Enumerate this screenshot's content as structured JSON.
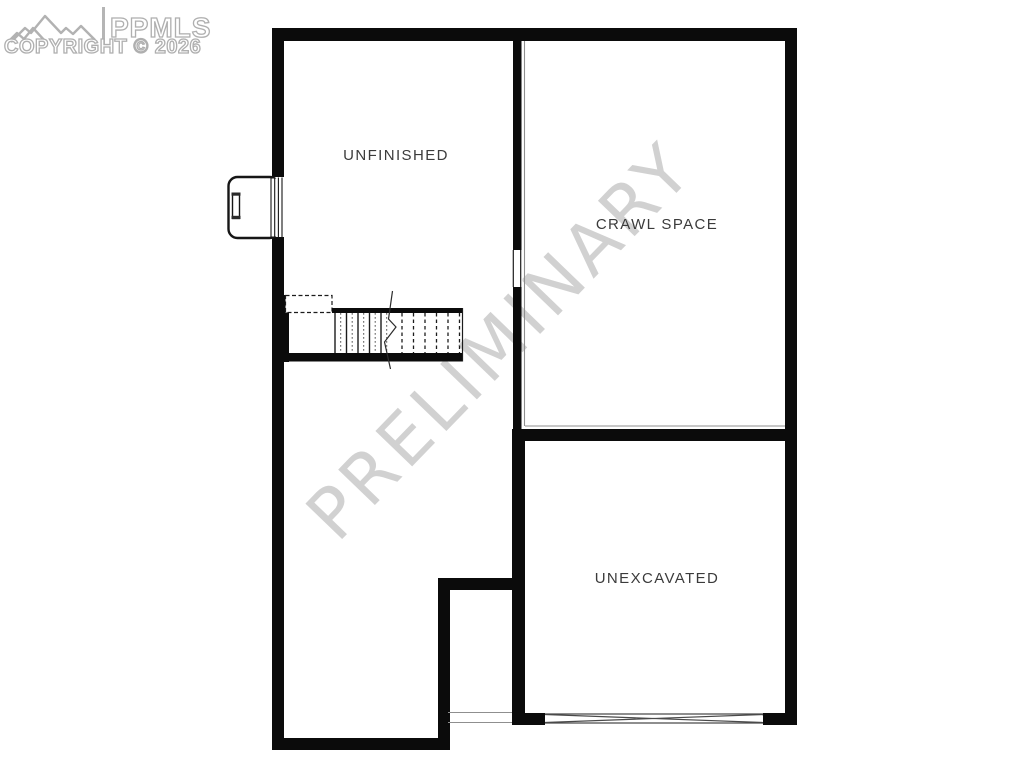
{
  "logo": {
    "brand": "PPMLS",
    "copyright": "COPYRIGHT © 2026",
    "icon": "mountain-range-icon",
    "color": "#afafaf"
  },
  "watermark": {
    "text": "PRELIMINARY",
    "color": "#c9c9c9",
    "rotation_deg": -46
  },
  "plan": {
    "type": "basement-floor-plan",
    "rooms": [
      {
        "id": "unfinished",
        "label": "UNFINISHED"
      },
      {
        "id": "crawl-space",
        "label": "CRAWL SPACE"
      },
      {
        "id": "unexcavated",
        "label": "UNEXCAVATED"
      }
    ],
    "symbols": [
      "window-well-icon",
      "egress-ladder-icon",
      "staircase-icon",
      "stair-break-line-icon",
      "beam-cross-icon",
      "crawl-ledge-line"
    ]
  },
  "colors": {
    "wall": "#0b0b0b",
    "thin_line": "#8f8f8f",
    "label_text": "#3b3b3b",
    "watermark": "#c9c9c9",
    "logo": "#afafaf",
    "background": "#ffffff"
  }
}
